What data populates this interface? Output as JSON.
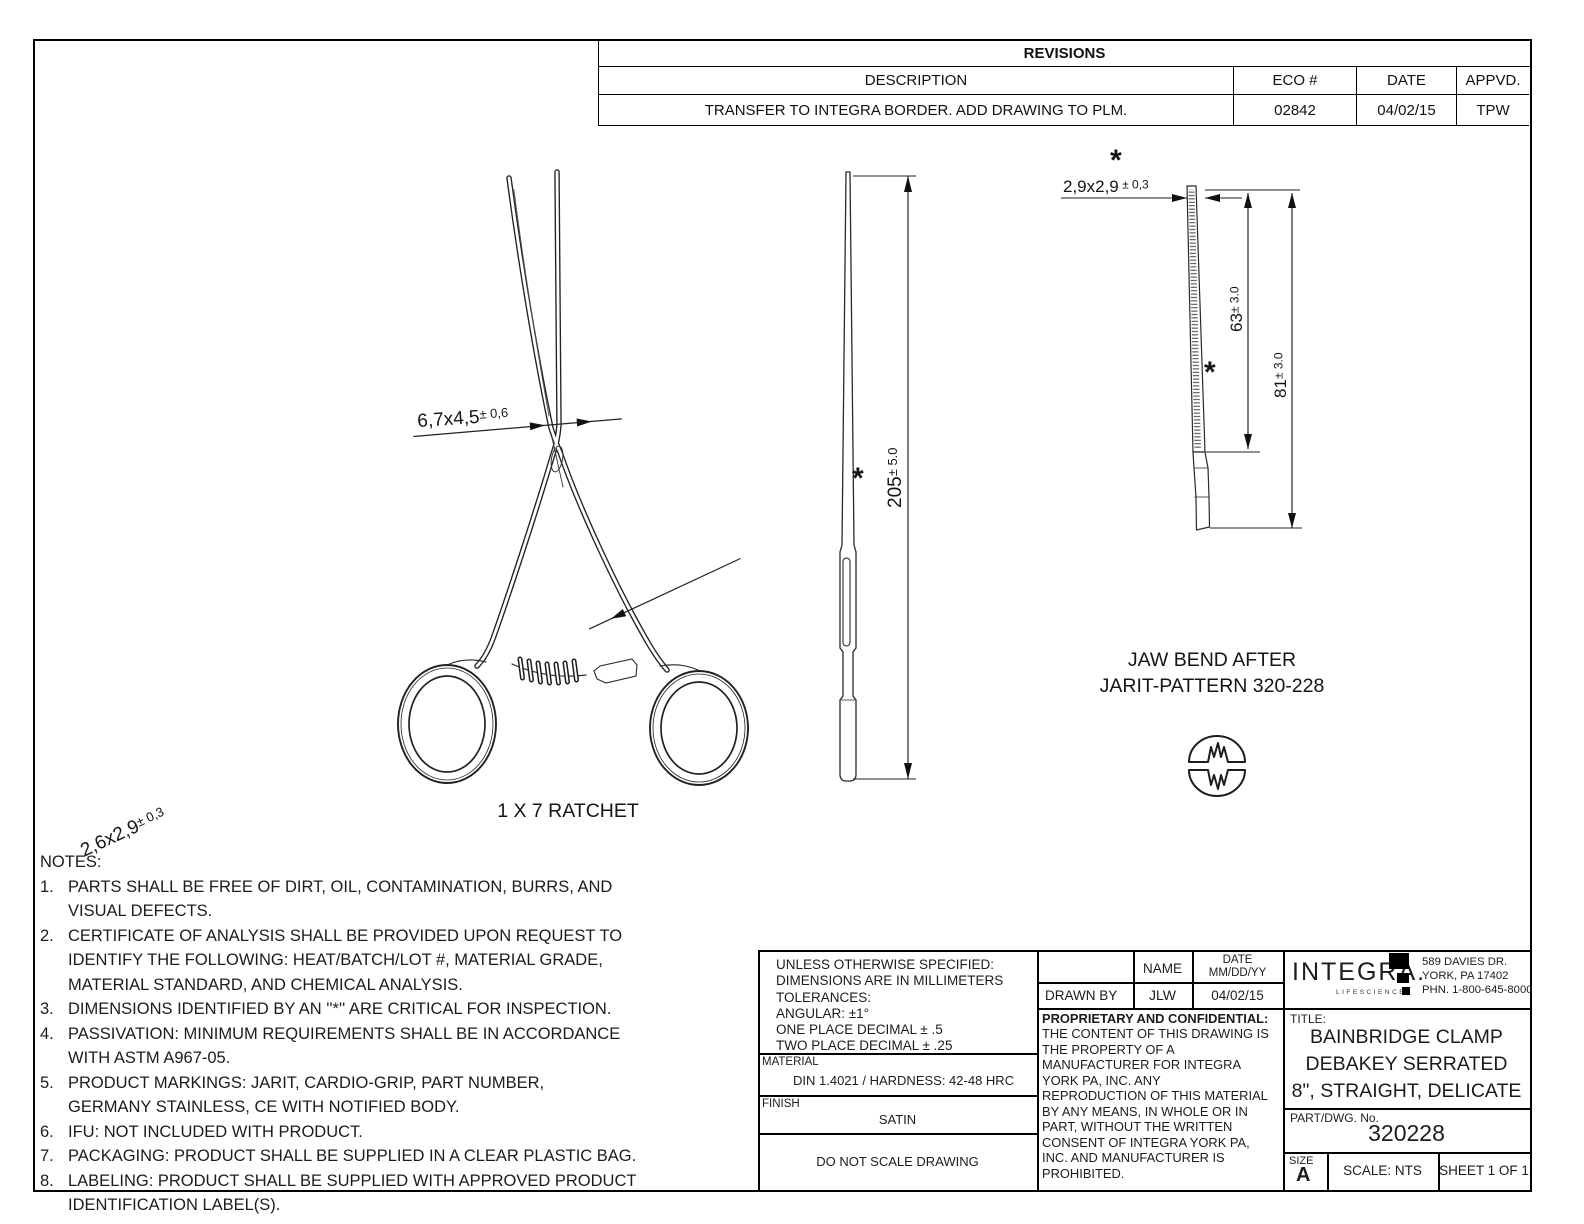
{
  "revisions": {
    "title": "REVISIONS",
    "col_description": "DESCRIPTION",
    "col_eco": "ECO #",
    "col_date": "DATE",
    "col_appvd": "APPVD.",
    "row": {
      "description": "TRANSFER TO INTEGRA BORDER. ADD DRAWING TO PLM.",
      "eco": "02842",
      "date": "04/02/15",
      "appvd": "TPW"
    }
  },
  "drawing": {
    "ratchet_label": "1 X 7 RATCHET",
    "asterisk": "*",
    "dims": {
      "joint": {
        "main": "6,7x4,5",
        "tol": "± 0,6"
      },
      "shank": {
        "main": "2,6x2,9",
        "tol": "± 0,3"
      },
      "length": {
        "main": "205",
        "tol": "± 5.0"
      },
      "jaw_tip": {
        "main": "2,9x2,9",
        "tol": " ± 0,3"
      },
      "serrated_len": {
        "main": "63",
        "tol": "± 3.0"
      },
      "jaw_len": {
        "main": "81",
        "tol": "± 3.0"
      }
    },
    "jaw_bend_line1": "JAW BEND AFTER",
    "jaw_bend_line2": "JARIT-PATTERN 320-228"
  },
  "notes": {
    "title": "NOTES:",
    "items": [
      {
        "num": "1.",
        "text": "PARTS SHALL BE FREE OF DIRT, OIL, CONTAMINATION, BURRS, AND\nVISUAL DEFECTS."
      },
      {
        "num": "2.",
        "text": "CERTIFICATE OF ANALYSIS SHALL BE PROVIDED UPON REQUEST TO\nIDENTIFY THE FOLLOWING: HEAT/BATCH/LOT #, MATERIAL GRADE,\nMATERIAL STANDARD, AND CHEMICAL ANALYSIS."
      },
      {
        "num": "3.",
        "text": "DIMENSIONS IDENTIFIED BY AN ''*'' ARE CRITICAL FOR INSPECTION."
      },
      {
        "num": "4.",
        "text": "PASSIVATION: MINIMUM REQUIREMENTS SHALL BE IN ACCORDANCE\nWITH ASTM A967-05."
      },
      {
        "num": "5.",
        "text": "PRODUCT MARKINGS: JARIT, CARDIO-GRIP, PART NUMBER,\nGERMANY STAINLESS, CE WITH NOTIFIED BODY."
      },
      {
        "num": "6.",
        "text": "IFU: NOT INCLUDED WITH PRODUCT."
      },
      {
        "num": "7.",
        "text": "PACKAGING: PRODUCT SHALL BE SUPPLIED IN A CLEAR PLASTIC BAG."
      },
      {
        "num": "8.",
        "text": "LABELING: PRODUCT SHALL BE SUPPLIED WITH APPROVED PRODUCT\nIDENTIFICATION LABEL(S)."
      }
    ]
  },
  "title_block": {
    "tolerances": "UNLESS OTHERWISE SPECIFIED:\nDIMENSIONS ARE IN MILLIMETERS\nTOLERANCES:\nANGULAR: ±1°\nONE PLACE DECIMAL ± .5\nTWO PLACE DECIMAL ± .25",
    "material_label": "MATERIAL",
    "material_value": "DIN 1.4021 / HARDNESS: 42-48 HRC",
    "finish_label": "FINISH",
    "finish_value": "SATIN",
    "do_not_scale": "DO NOT SCALE DRAWING",
    "name_header": "NAME",
    "date_header": "DATE\nMM/DD/YY",
    "drawn_by_label": "DRAWN BY",
    "drawn_by_name": "JLW",
    "drawn_by_date": "04/02/15",
    "proprietary_heading": "PROPRIETARY AND CONFIDENTIAL:",
    "proprietary_body": "THE CONTENT OF THIS DRAWING IS\nTHE PROPERTY OF A\nMANUFACTURER FOR INTEGRA\nYORK PA, INC. ANY\nREPRODUCTION OF THIS MATERIAL\nBY ANY MEANS, IN WHOLE OR IN\nPART, WITHOUT THE WRITTEN\nCONSENT OF INTEGRA YORK PA,\nINC. AND MANUFACTURER IS\nPROHIBITED.",
    "company": {
      "logo": "INTEGRA.",
      "tagline": "LIFESCIENCES",
      "address": "589 DAVIES DR.\nYORK, PA 17402\nPHN. 1-800-645-8000"
    },
    "title_label": "TITLE:",
    "title_lines": [
      "BAINBRIDGE CLAMP",
      "DEBAKEY SERRATED",
      "8\", STRAIGHT, DELICATE"
    ],
    "part_label": "PART/DWG. No.",
    "part_number": "320228",
    "size_label": "SIZE",
    "size_value": "A",
    "scale": "SCALE: NTS",
    "sheet": "SHEET 1 OF 1"
  }
}
